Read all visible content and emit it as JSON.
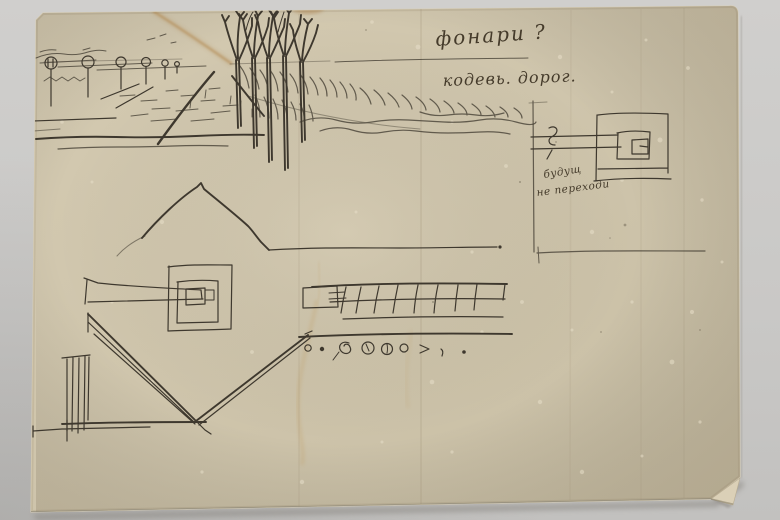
{
  "annotations": {
    "top_right_line1": "фонари ?",
    "top_right_line2": "кодевь. дорог.",
    "plan_note_line1": "будущ",
    "plan_note_line2": "не переходи"
  },
  "colors": {
    "background": "#c9c8c6",
    "paper": "#cfc5ac",
    "ink": "#3e382e",
    "stain": "#b68a50"
  }
}
